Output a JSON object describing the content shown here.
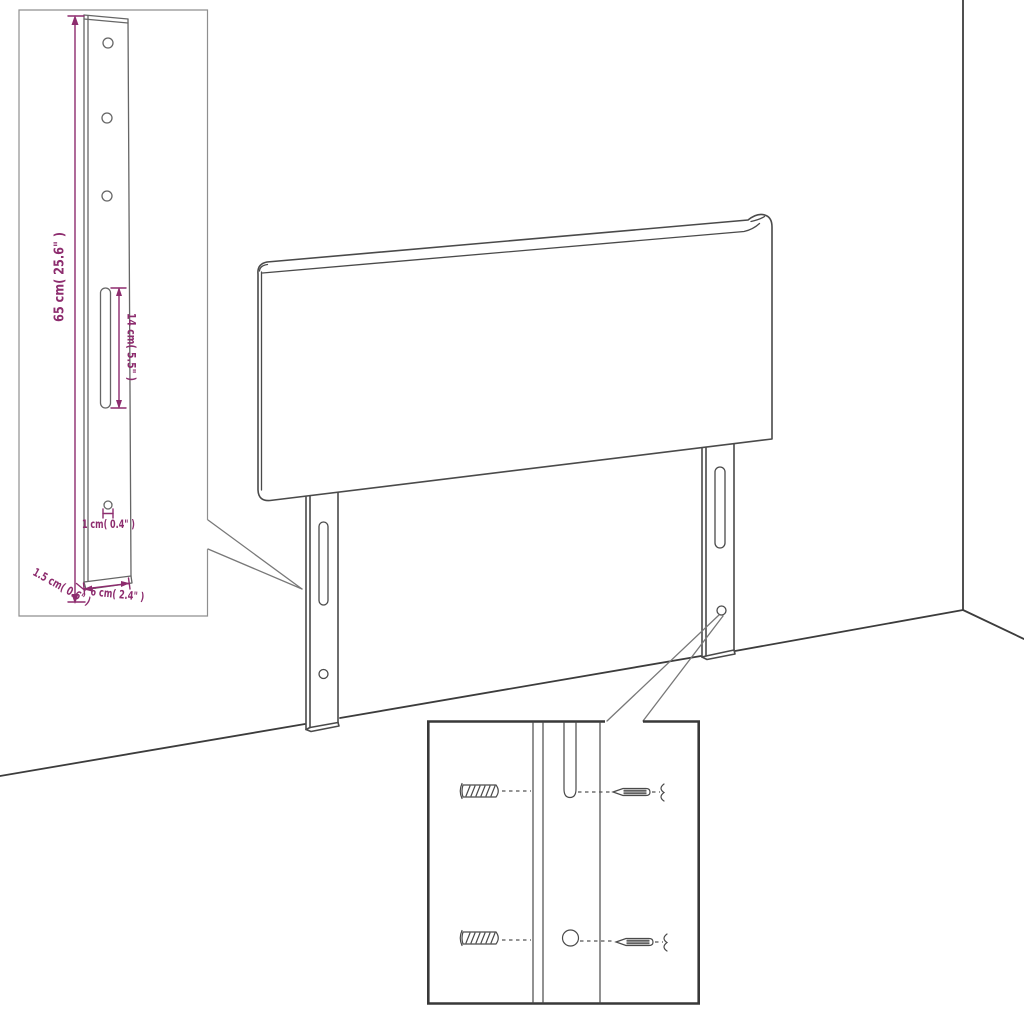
{
  "diagram": {
    "background": "#ffffff",
    "description": "Assembly drawing of an upholstered headboard with two slotted mounting legs, a dimensioned leg detail inset and a wall-fixing hardware inset",
    "colors": {
      "outline": "#4a4a4a",
      "wall_line": "#3c3c3c",
      "inset_border_light": "#8f8f8f",
      "inset_border_dark": "#383838",
      "callout_line": "#787878",
      "dimension": "#8d2c6e"
    },
    "leg_detail_inset": {
      "labels": {
        "leg_height": "65 cm( 25.6\" )",
        "slot_length": "14 cm( 5.5\" )",
        "hole_diameter": "1 cm( 0.4\" )",
        "leg_thickness": "1.5 cm( 0.6\" )",
        "leg_width": "6 cm( 2.4\" )"
      }
    }
  }
}
